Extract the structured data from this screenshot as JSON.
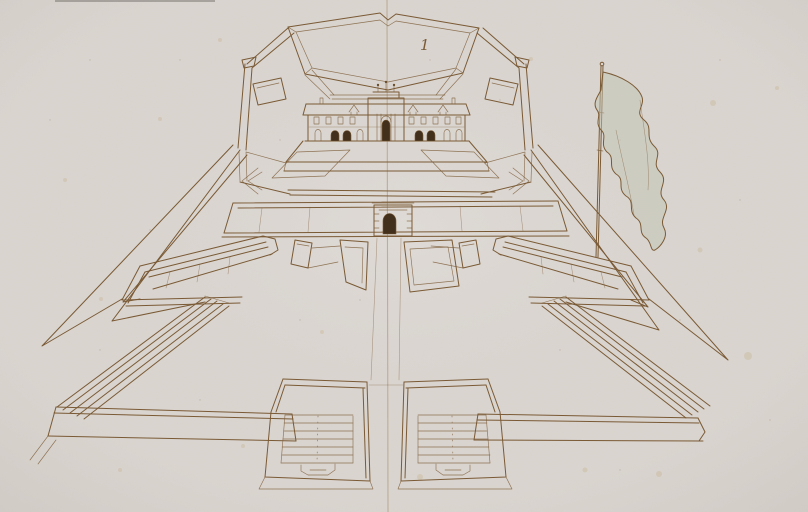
{
  "artwork": {
    "annotation_label": "1",
    "type": "pen-and-ink fortification drawing on folded paper",
    "subject": "Bird's-eye perspective of a star fort with central palace courtyard, arched gate, demi-bastions, ramps, two stepped outworks and a banner on a staff",
    "colors": {
      "paper": "#dcd7d2",
      "ink": "#7a5a35",
      "inkdark": "#42301d",
      "wash": "#c2c3b3",
      "fold": "#b6a68c",
      "foxing": "#c3a87e"
    }
  }
}
